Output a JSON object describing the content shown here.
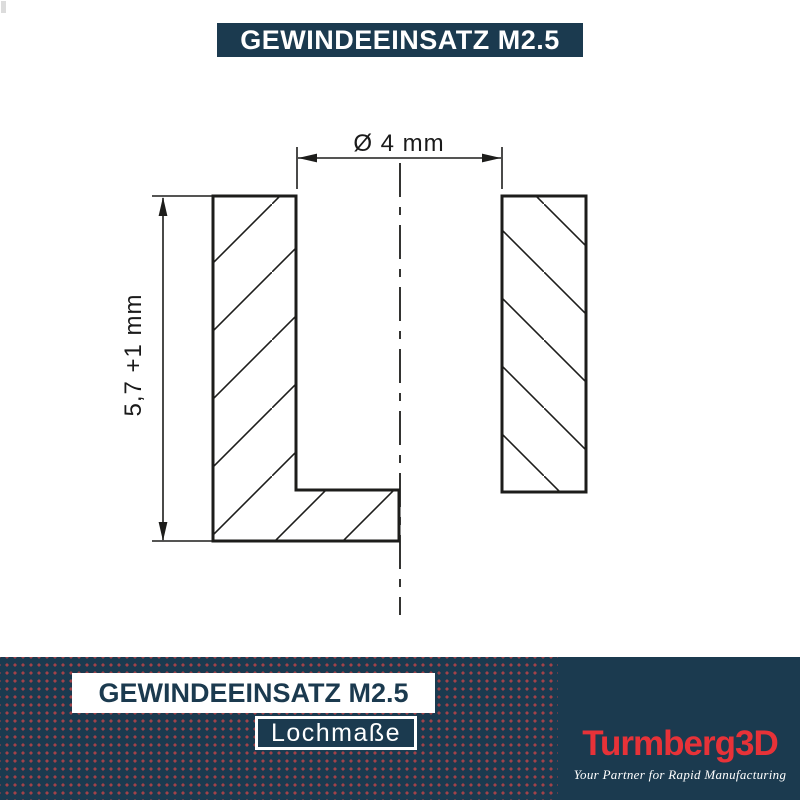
{
  "header": {
    "title": "GEWINDEEINSATZ M2.5"
  },
  "drawing": {
    "diameter_label": "Ø 4 mm",
    "depth_label": "5,7 +1 mm"
  },
  "footer": {
    "title": "GEWINDEEINSATZ M2.5",
    "subtitle": "Lochmaße",
    "brand": {
      "name": "Turmberg3D",
      "tagline": "Your Partner for Rapid Manufacturing"
    }
  },
  "colors": {
    "navy": "#1b3a4f",
    "dot": "#a24249",
    "brand_red": "#e73238",
    "line": "#1d1d1b",
    "dim_text": "#1a1a1a"
  }
}
